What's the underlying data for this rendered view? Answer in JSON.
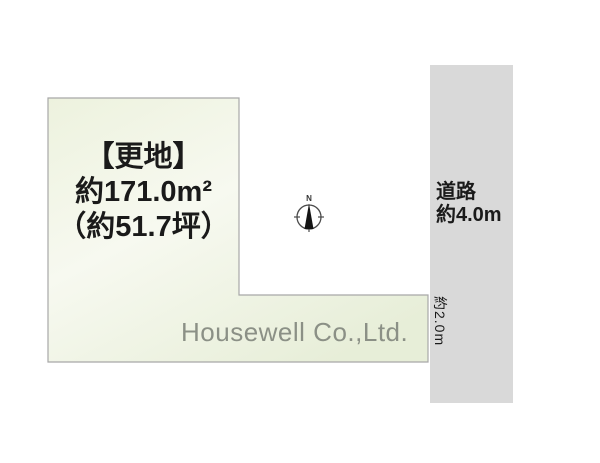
{
  "lot": {
    "status": "【更地】",
    "area_sqm": "約171.0m²",
    "area_tsubo": "（約51.7坪）",
    "watermark": "Housewell Co.,Ltd."
  },
  "road": {
    "label": "道路",
    "width": "約4.0m",
    "frontage": "約2.0m"
  },
  "compass": {
    "north_label": "N"
  },
  "colors": {
    "lot_fill_top": "#edf2de",
    "lot_fill_mid": "#f7f9f0",
    "lot_fill_bottom": "#e7eed8",
    "lot_border": "#a8a8a8",
    "road_fill": "#d9d9d9",
    "label_text": "#1a1a1a",
    "watermark_text": "#8b9086",
    "compass_ring": "#4a4a4a",
    "compass_needle": "#141414"
  }
}
